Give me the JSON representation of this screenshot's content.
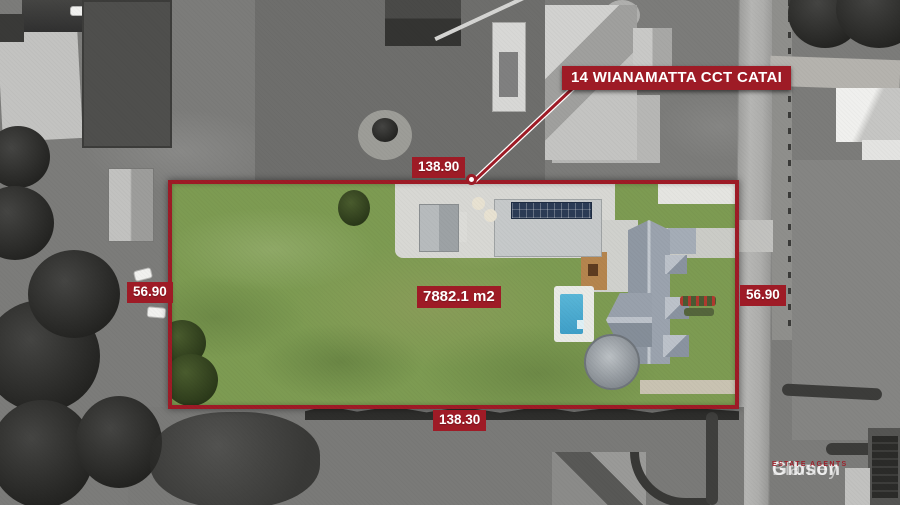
{
  "annotations": {
    "address_banner": "14 WIANAMATTA CCT CATAI",
    "area": "7882.1 m2",
    "boundary_top": "138.90",
    "boundary_bottom": "138.30",
    "boundary_left": "56.90",
    "boundary_right": "56.90"
  },
  "watermark": {
    "brand_light": "Blamey",
    "brand_bold": "Gibson",
    "tagline": "ESTATE AGENTS"
  },
  "colors": {
    "red": "#9e1b26",
    "label_text": "#ffffff",
    "lawn": "#7d9b52",
    "pool": "#3f9fc8",
    "solar": "#2b3b55"
  }
}
